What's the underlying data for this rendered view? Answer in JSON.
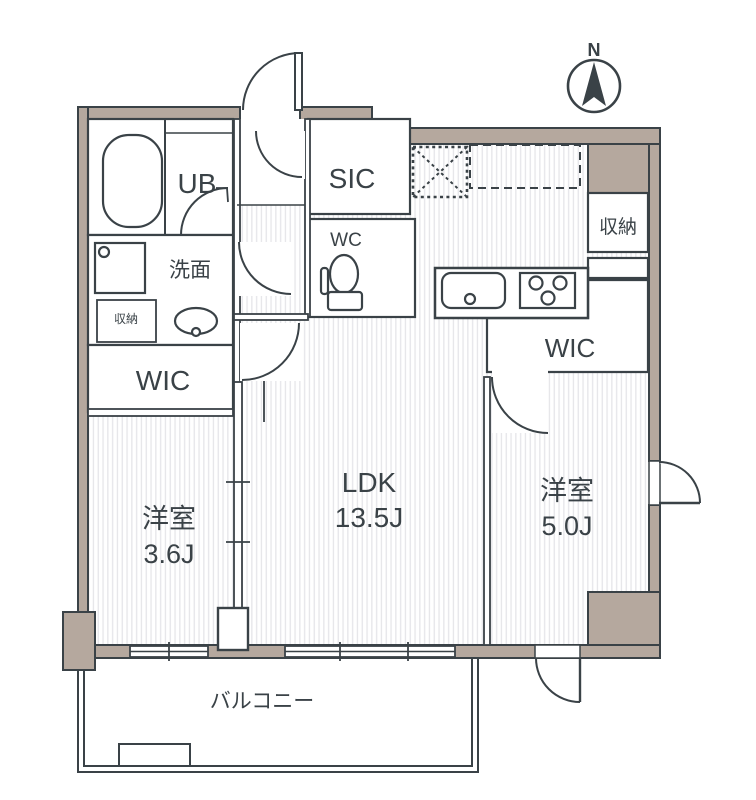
{
  "compass": {
    "label": "N"
  },
  "rooms": {
    "unit_bath": {
      "label": "UB"
    },
    "washroom": {
      "label": "洗面"
    },
    "storage_small": {
      "label": "収納"
    },
    "wic_left": {
      "label": "WIC"
    },
    "bedroom_left": {
      "label": "洋室",
      "size": "3.6J"
    },
    "shoe_closet": {
      "label": "SIC"
    },
    "toilet": {
      "label": "WC"
    },
    "ldk": {
      "label": "LDK",
      "size": "13.5J"
    },
    "storage_right": {
      "label": "収納"
    },
    "wic_right": {
      "label": "WIC"
    },
    "bedroom_right": {
      "label": "洋室",
      "size": "5.0J"
    },
    "balcony": {
      "label": "バルコニー"
    }
  },
  "colors": {
    "wall_fill": "#b5a89e",
    "line": "#3a4247",
    "floor_stripe": "#e6e6e9"
  }
}
